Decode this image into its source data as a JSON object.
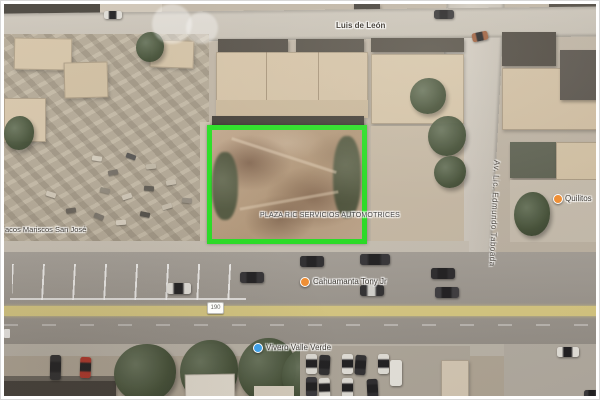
{
  "streets": {
    "top_street": "Luis de León",
    "vertical_street": "Av. Lic. Edmundo Taboada",
    "route_shield": "190"
  },
  "labels": {
    "parcel_business": "PLAZA RIC SERVICIOS AUTOMOTRICES",
    "poi_left": "acos Mariscos San José",
    "poi_center": "Cahuamanta Tony Jr",
    "poi_bottom": "Vivero Valle Verde",
    "poi_right": "Quilitos"
  },
  "highlight": {
    "parcel_outline_color": "#22e420"
  },
  "colors": {
    "poi_orange": "#ef8f35",
    "poi_blue": "#3fa0e8",
    "route_yellow": "#ebda80",
    "road_gray": "#a09b94"
  }
}
